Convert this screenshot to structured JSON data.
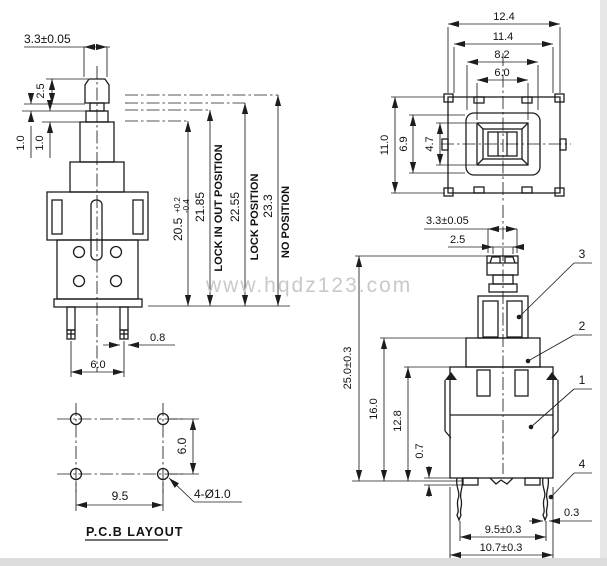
{
  "watermark": "www.hqdz123.com",
  "front_view": {
    "dim_cap_width": "3.3±0.05",
    "dim_cap_height": "2.5",
    "dim_neck_height": "1.0",
    "dim_collar_height": "1.0",
    "dim_travel_main": "20.5",
    "dim_travel_tol_plus": "+0.2",
    "dim_travel_tol_minus": "-0.4",
    "dim_height_lock_in_out": "21.85",
    "dim_height_lock": "22.55",
    "dim_height_free": "23.3",
    "label_lock_in_out": "LOCK IN OUT POSITION",
    "label_lock": "LOCK POSITION",
    "label_no": "NO POSITION",
    "dim_pin_width": "0.8",
    "dim_pin_pitch": "6.0"
  },
  "top_view": {
    "dim_outer_width": "12.4",
    "dim_body_width": "11.4",
    "dim_frame_width": "8.2",
    "dim_button_width": "6.0",
    "dim_outer_height": "11.0",
    "dim_frame_height": "6.9",
    "dim_button_height": "4.7"
  },
  "side_view": {
    "dim_cap_width": "3.3±0.05",
    "dim_cap_top_width": "2.5",
    "dim_total_height": "25.0±0.3",
    "dim_upper_height": "16.0",
    "dim_body_height": "12.8",
    "dim_boss_height": "0.7",
    "dim_pin_pitch": "9.5±0.3",
    "dim_body_width": "10.7±0.3",
    "dim_pin_thickness": "0.3",
    "callout_base": "1",
    "callout_frame": "2",
    "callout_stem": "3",
    "callout_terminal": "4"
  },
  "pcb_layout": {
    "title": "P.C.B LAYOUT",
    "dim_hole_pitch_v": "6.0",
    "dim_hole_pitch_h": "9.5",
    "note_holes": "4-Ø1.0"
  }
}
